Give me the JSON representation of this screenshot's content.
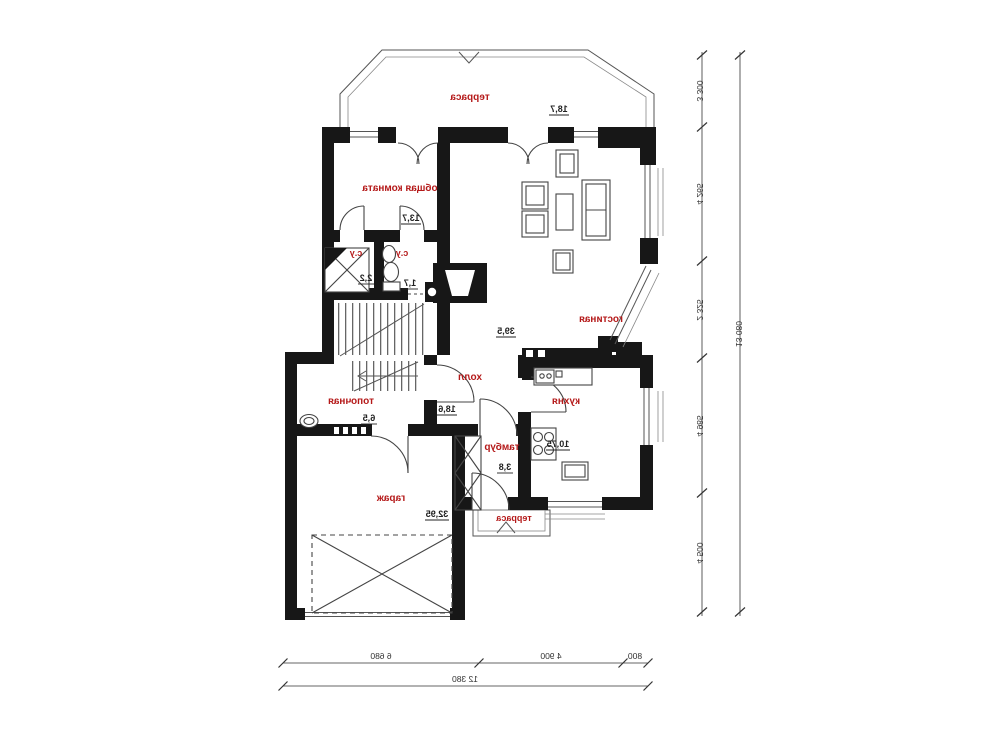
{
  "plan_title": "first floor plan (mirrored print)",
  "rooms": [
    {
      "label": "терраса",
      "area": "18,7"
    },
    {
      "label": "общая комната",
      "area": "13,7"
    },
    {
      "label": "с.у",
      "area": "2,2"
    },
    {
      "label": "с.у",
      "area": "1,7"
    },
    {
      "label": "гостиная",
      "area": "39,5"
    },
    {
      "label": "холл",
      "area": "18,6"
    },
    {
      "label": "кухня",
      "area": "10,75"
    },
    {
      "label": "топочная",
      "area": "6,5"
    },
    {
      "label": "тамбур",
      "area": "3,8"
    },
    {
      "label": "гараж",
      "area": "32,95"
    },
    {
      "label": "терраса",
      "area": ""
    }
  ],
  "dimensions": {
    "vertical_chain": [
      "3 300",
      "4 265",
      "2 325",
      "4 985",
      "4 500"
    ],
    "vertical_total": "13 080",
    "horizontal_chain": [
      "6 680",
      "4 900",
      "800"
    ],
    "horizontal_total": "12 380"
  },
  "colors": {
    "walls": "#171717",
    "room_labels": "#b51a1a",
    "dimension_text": "#333333",
    "background": "#ffffff"
  }
}
